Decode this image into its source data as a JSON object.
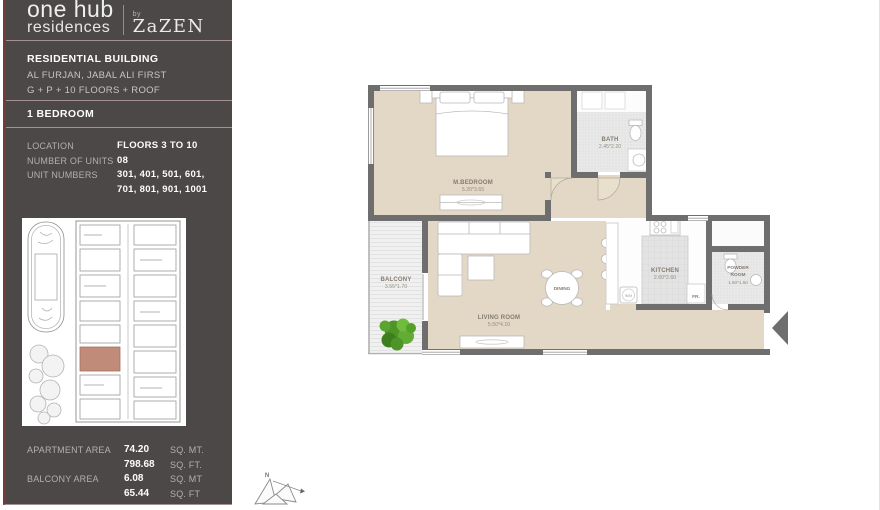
{
  "brand": {
    "line1": "one hub",
    "line2": "residences",
    "by": "by",
    "developer": "ZaZEN"
  },
  "building": {
    "title": "RESIDENTIAL BUILDING",
    "address": "AL FURJAN, JABAL ALI FIRST",
    "floors": "G + P + 10 FLOORS + ROOF",
    "unit_type": "1 BEDROOM"
  },
  "details": {
    "location_label": "LOCATION",
    "location_value": "FLOORS 3 TO 10",
    "units_label": "NUMBER OF UNITS",
    "units_value": "08",
    "unit_numbers_label": "UNIT NUMBERS",
    "unit_numbers_line1": "301, 401, 501, 601,",
    "unit_numbers_line2": "701, 801, 901, 1001"
  },
  "areas": {
    "apartment_label": "APARTMENT AREA",
    "apartment_sqmt": "74.20",
    "apartment_sqmt_unit": "SQ. MT.",
    "apartment_sqft": "798.68",
    "apartment_sqft_unit": "SQ. FT.",
    "balcony_label": "BALCONY AREA",
    "balcony_sqmt": "6.08",
    "balcony_sqmt_unit": "SQ. MT",
    "balcony_sqft": "65.44",
    "balcony_sqft_unit": "SQ. FT"
  },
  "floorplan": {
    "labels": {
      "mbedroom": "M.BEDROOM",
      "mbedroom_dim": "5.20*3.65",
      "bath": "BATH",
      "bath_dim": "2.45*2.20",
      "balcony": "BALCONY",
      "balcony_dim": "3.55*1.70",
      "living": "LIVING ROOM",
      "living_dim": "5.50*4.10",
      "dining": "DINING",
      "kitchen": "KITCHEN",
      "kitchen_dim": "2.60*2.60",
      "powder_line1": "POWDER",
      "powder_line2": "ROOM",
      "powder_dim": "1.60*1.50",
      "fridge": "FR.",
      "washer": "W/M"
    }
  },
  "compass": {
    "north": "N"
  },
  "colors": {
    "sidebar_bg": "#4c4848",
    "accent_maroon": "#6e3c3c",
    "divider": "#a59191",
    "floor_beige": "#e2d8c5",
    "wall_gray": "#6e6e6e",
    "plant_green": "#4e9427",
    "keyplan_highlight": "#c08b78"
  }
}
